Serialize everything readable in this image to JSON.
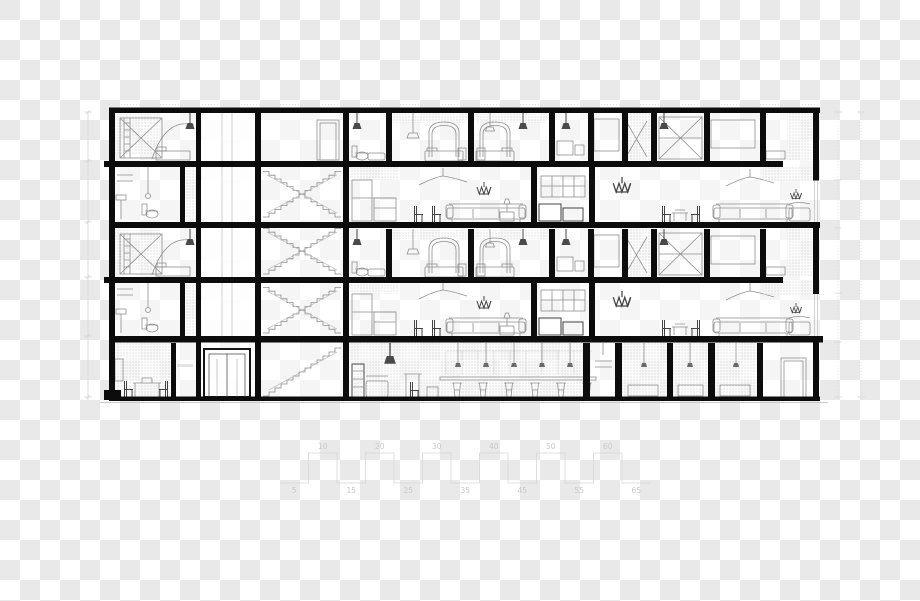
{
  "canvas": {
    "width": 920,
    "height": 601
  },
  "background": {
    "style": "transparency-checkerboard",
    "checker_light": "#ffffff",
    "checker_dark": "#e9e9e9",
    "tile_px": 20
  },
  "drawing": {
    "kind": "architectural-building-cross-section",
    "floors_visible": 5,
    "ink_color": "#0c0c0c",
    "lineart_color": "#8e8e8e",
    "dark_accent_color": "#444444",
    "hatch_dot_color": "#b6b6b6",
    "dimension_color": "#d6d6d6"
  },
  "icons": {
    "pendant-lamp-icon": "cone-on-cord",
    "chandelier-icon": "zigzag-basket",
    "ceiling-fan-icon": "stem-with-blades",
    "bed-icon": "arched-headboard-bed",
    "chair-icon": "side-profile-chair",
    "sofa-icon": "low-long-seat",
    "stair-icon": "stepped-scissor-flights",
    "elevator-icon": "double-outline-cab",
    "door-icon": "double-outline-door",
    "bar-stool-icon": "x-leg-stool"
  },
  "scale_bar": {
    "line_color": "#d6d6d6",
    "text_color": "#c9c9c9",
    "top_labels": [
      "10",
      "20",
      "30",
      "40",
      "50",
      "60"
    ],
    "bottom_labels": [
      "5",
      "15",
      "25",
      "35",
      "45",
      "55",
      "65"
    ]
  }
}
